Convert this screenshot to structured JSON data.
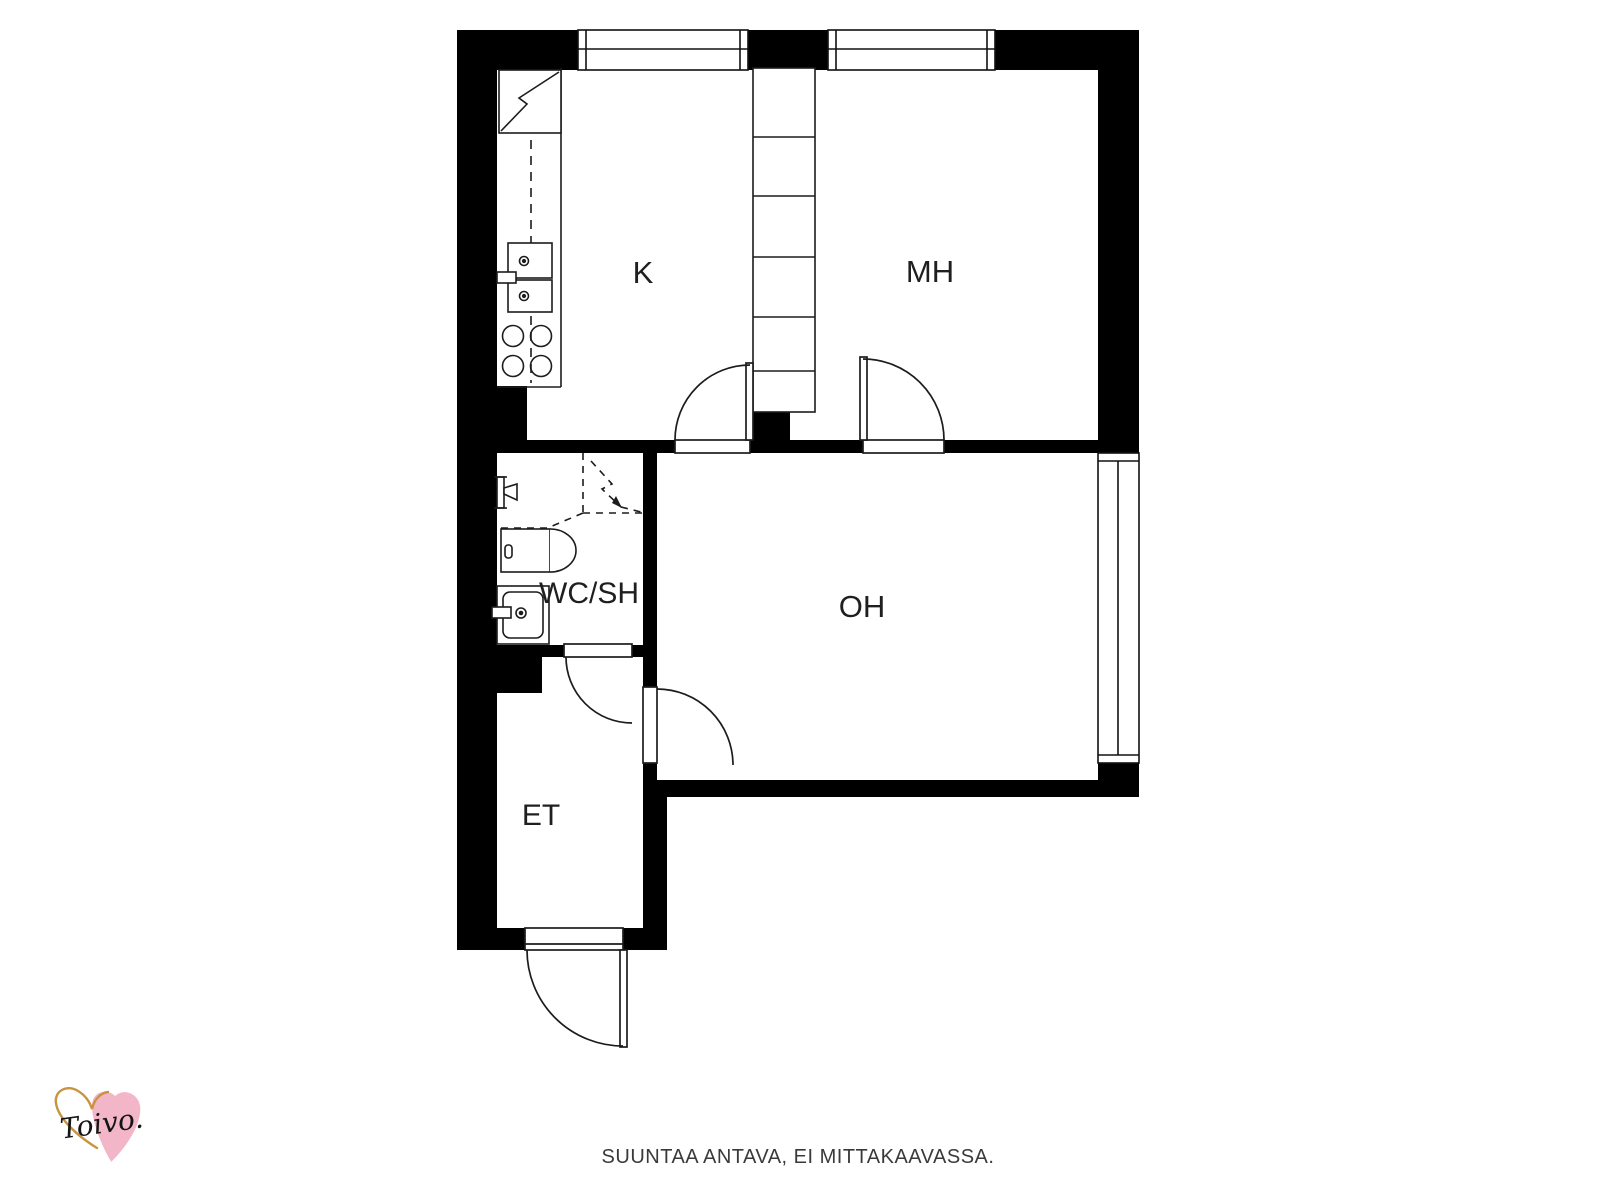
{
  "plan": {
    "rooms": [
      {
        "id": "kitchen",
        "label": "K"
      },
      {
        "id": "bedroom",
        "label": "MH"
      },
      {
        "id": "living_room",
        "label": "OH"
      },
      {
        "id": "bathroom",
        "label": "WC/SH"
      },
      {
        "id": "entry",
        "label": "ET"
      }
    ],
    "colors": {
      "wall": "#000000",
      "line": "#1c1c1c",
      "label": "#1f1f1f"
    }
  },
  "footer": {
    "disclaimer": "SUUNTAA ANTAVA, EI MITTAKAAVASSA."
  },
  "logo": {
    "brand": "Toivo.",
    "pink": "#f3b6c9",
    "gold": "#c9943f"
  }
}
